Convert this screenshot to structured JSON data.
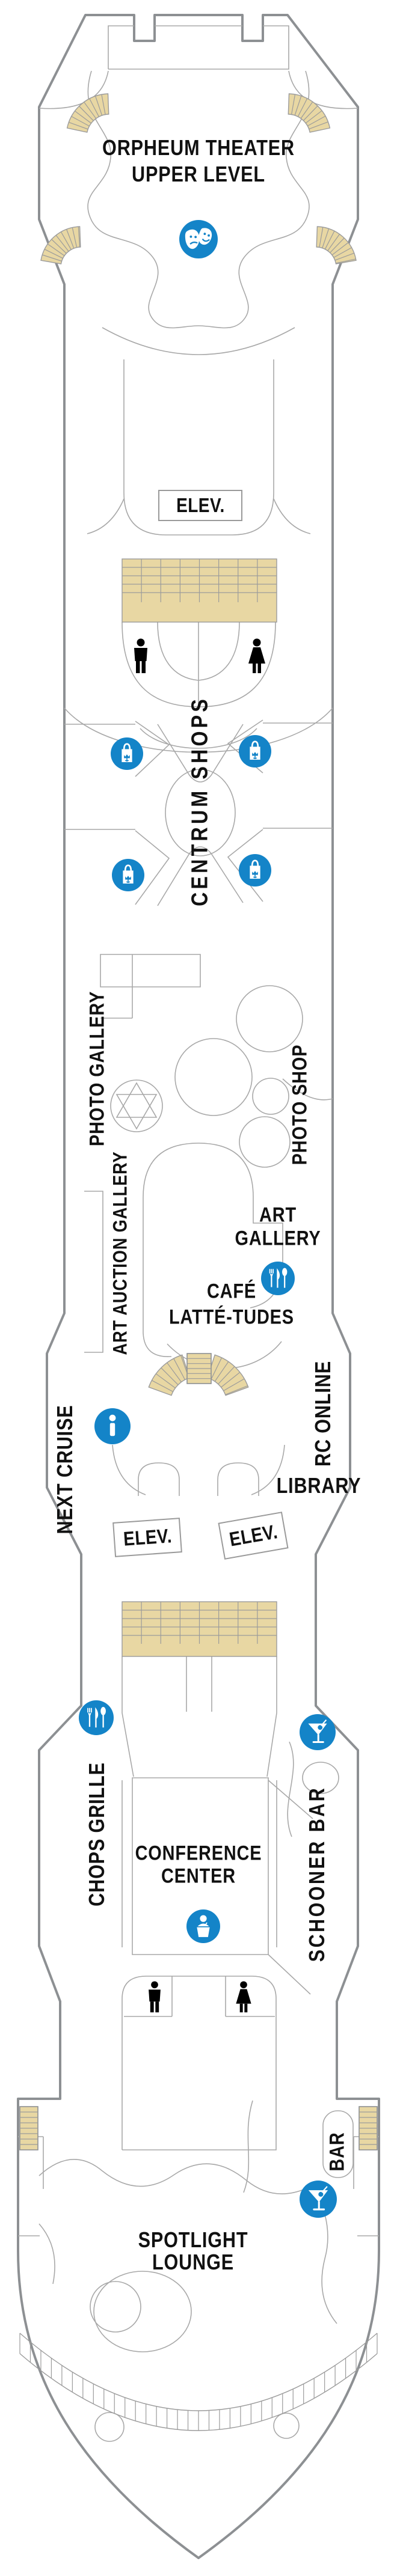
{
  "deck_plan": {
    "venues": {
      "orpheum_theater": {
        "line1": "ORPHEUM THEATER",
        "line2": "UPPER LEVEL"
      },
      "centrum_shops": {
        "label": "CENTRUM SHOPS"
      },
      "photo_gallery": {
        "label": "PHOTO GALLERY"
      },
      "art_auction_gallery": {
        "label": "ART AUCTION GALLERY"
      },
      "photo_shop": {
        "label": "PHOTO SHOP"
      },
      "art_gallery": {
        "line1": "ART",
        "line2": "GALLERY"
      },
      "cafe_lattetudes": {
        "line1": "CAFÉ",
        "line2": "LATTÉ-TUDES"
      },
      "next_cruise": {
        "label": "NEXT CRUISE"
      },
      "rc_online": {
        "label": "RC ONLINE"
      },
      "library": {
        "label": "LIBRARY"
      },
      "chops_grille": {
        "label": "CHOPS GRILLE"
      },
      "schooner_bar": {
        "label": "SCHOONER BAR"
      },
      "conference_center": {
        "line1": "CONFERENCE",
        "line2": "CENTER"
      },
      "bar": {
        "label": "BAR"
      },
      "spotlight_lounge": {
        "line1": "SPOTLIGHT",
        "line2": "LOUNGE"
      }
    },
    "elevator_labels": [
      "ELEV.",
      "ELEV.",
      "ELEV."
    ],
    "icons": [
      "theater-masks-icon",
      "shopping-bag-icon",
      "dining-icon",
      "info-icon",
      "martini-icon",
      "lectern-speaker-icon",
      "mens-restroom-icon",
      "womens-restroom-icon"
    ],
    "colors": {
      "icon_blue": "#1484c8",
      "stair_tan": "#e8d7a3",
      "hull_gray": "#8d9093",
      "wall_gray": "#a8a8a8",
      "label_black": "#111111"
    }
  }
}
